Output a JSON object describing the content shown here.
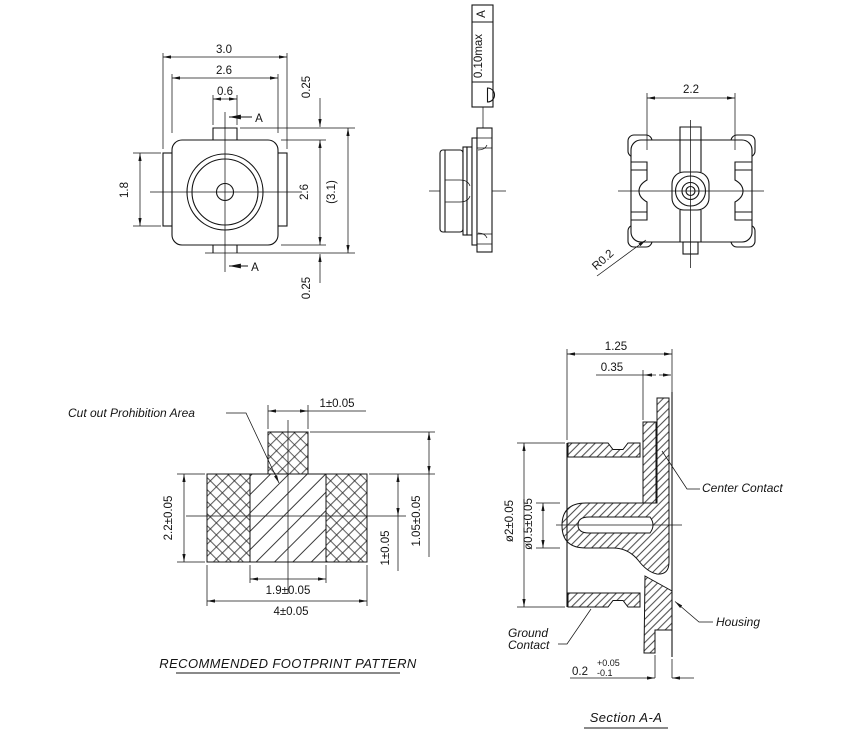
{
  "drawing": {
    "front_view": {
      "dim_overall_width": "3.0",
      "dim_body_width": "2.6",
      "dim_stem_width": "0.6",
      "dim_top_offset": "0.25",
      "dim_tab_height": "1.8",
      "dim_body_height": "2.6",
      "dim_overall_height": "(3.1)",
      "dim_bottom_offset": "0.25",
      "section_arrow_top": "A",
      "section_arrow_bottom": "A"
    },
    "side_view": {
      "tolerance_value": "0.10max",
      "datum_ref": "A"
    },
    "bottom_view": {
      "dim_width": "2.2",
      "dim_corner_radius": "R0.2"
    },
    "footprint": {
      "callout": "Cut out Prohibition Area",
      "dim_top_pad_width": "1±0.05",
      "dim_pad_height": "2.2±0.05",
      "dim_inner_span": "1.9±0.05",
      "dim_overall_width": "4±0.05",
      "dim_center_to_pad_bottom": "1±0.05",
      "dim_top_pad_height": "1.05±0.05",
      "title": "RECOMMENDED FOOTPRINT PATTERN"
    },
    "section_view": {
      "dim_height": "1.25",
      "dim_offset": "0.35",
      "dim_outer_dia": "ø2±0.05",
      "dim_inner_dia": "ø0.5±0.05",
      "dim_standoff": "0.2",
      "dim_standoff_plus": "+0.05",
      "dim_standoff_minus": "-0.1",
      "label_center_contact": "Center Contact",
      "label_housing": "Housing",
      "label_ground_line1": "Ground",
      "label_ground_line2": "Contact",
      "title": "Section A-A"
    }
  }
}
